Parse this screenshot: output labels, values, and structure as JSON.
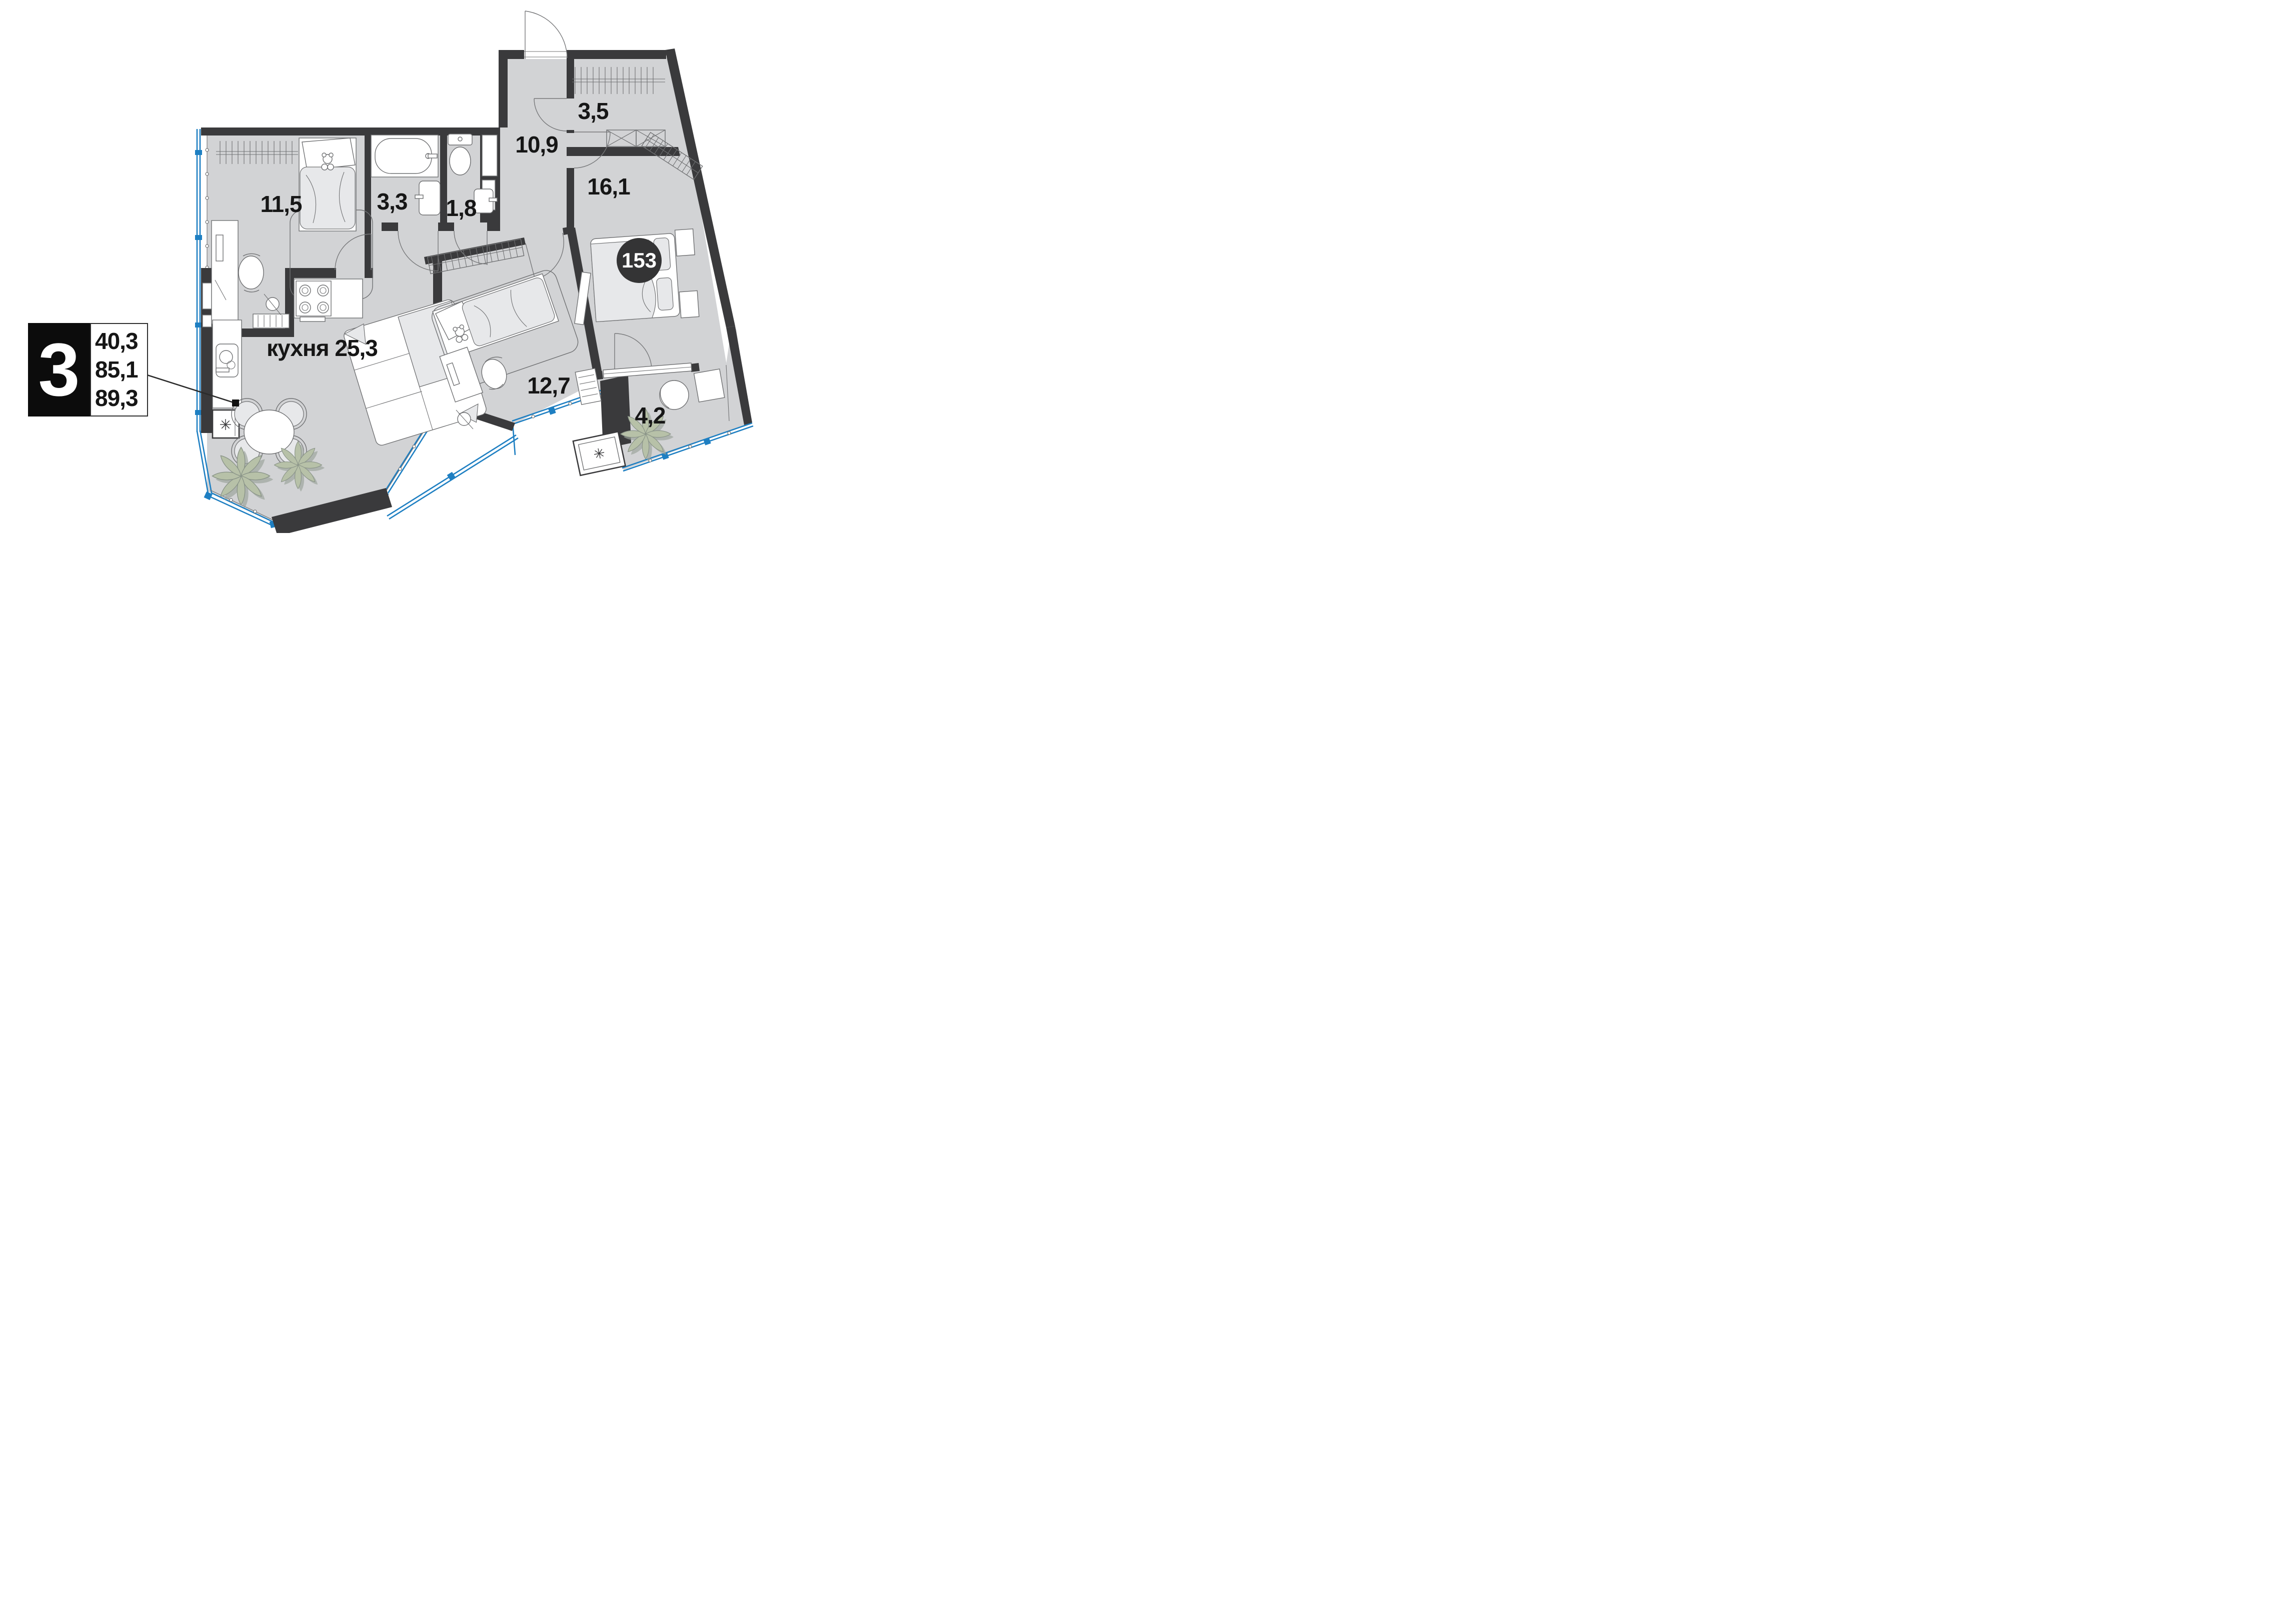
{
  "plan": {
    "legend": {
      "rooms_count": "3",
      "living_area": "40,3",
      "apartment_area": "85,1",
      "total_area": "89,3"
    },
    "apartment_number": "153",
    "rooms": [
      {
        "id": "bedroom-1",
        "area_label": "11,5"
      },
      {
        "id": "bathroom",
        "area_label": "3,3"
      },
      {
        "id": "wc",
        "area_label": "1,8"
      },
      {
        "id": "hallway",
        "area_label": "10,9"
      },
      {
        "id": "closet",
        "area_label": "3,5"
      },
      {
        "id": "bedroom-2",
        "area_label": "16,1"
      },
      {
        "id": "kitchen-living",
        "name": "кухня",
        "area_label": "25,3"
      },
      {
        "id": "bedroom-3",
        "area_label": "12,7"
      },
      {
        "id": "balcony",
        "area_label": "4,2"
      }
    ],
    "symbols": {
      "vent": "✳"
    },
    "colors": {
      "wall": "#3a3a3c",
      "floor": "#d2d3d5",
      "glazing_blue": "#1e7fc2",
      "plant_green": "#b7c1a8",
      "number_circle": "#343435"
    }
  }
}
